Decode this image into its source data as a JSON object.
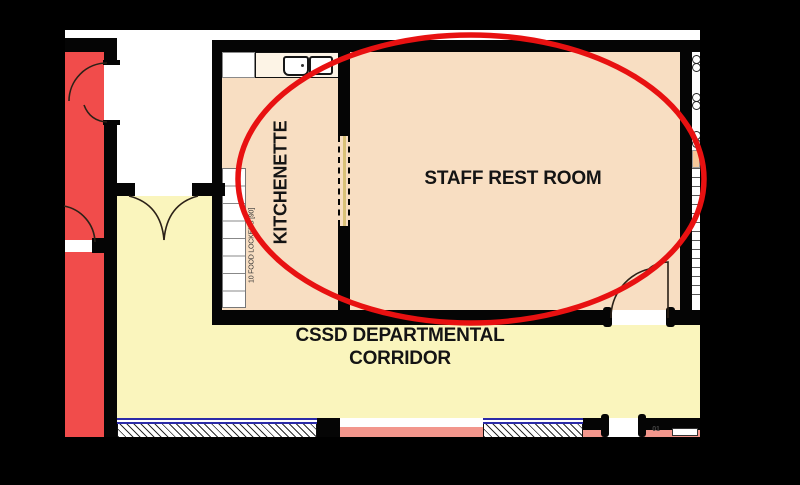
{
  "plan_type": "floor-plan",
  "rooms": {
    "kitchenette": {
      "label": "KITCHENETTE"
    },
    "staff_rest_room": {
      "label": "STAFF REST ROOM"
    },
    "corridor": {
      "label_line1": "CSSD DEPARTMENTAL",
      "label_line2": "CORRIDOR"
    }
  },
  "notes": {
    "food_lockers": "10 FOOD LOCKERS [90]",
    "door_tag": "01"
  },
  "colors": {
    "background": "#000000",
    "highlight_ellipse": "#e81111",
    "red_room": "#f14c4b",
    "corridor_yellow": "#faf5bd",
    "room_peach": "#f8dec2",
    "salmon_strip": "#f2968c",
    "window_blue": "#2b2ba8",
    "partition_tan": "#d9c178",
    "wall": "#050505"
  }
}
